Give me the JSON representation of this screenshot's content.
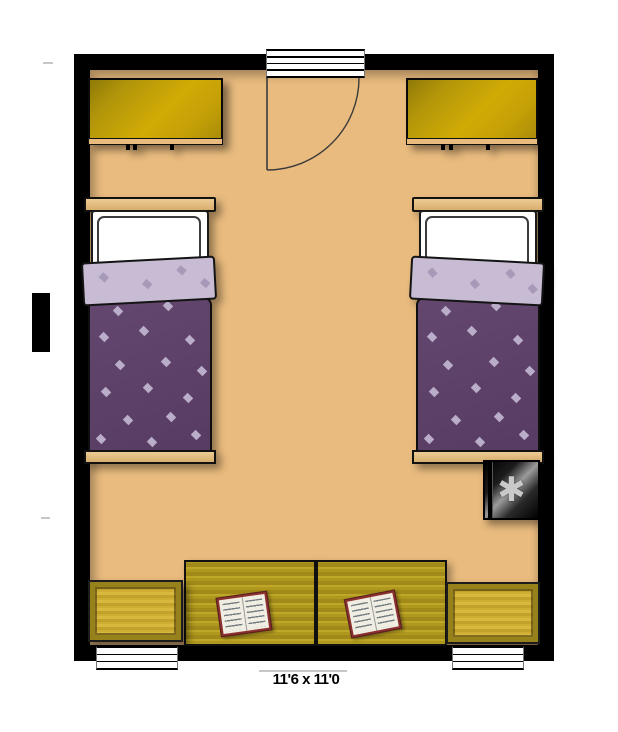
{
  "room": {
    "dimensions_label": "11'6 x 11'0",
    "colors": {
      "wall": "#000000",
      "floor": "#e9bb7e",
      "wardrobe_gold": "#c7a307",
      "duvet_purple": "#5c3f68",
      "sheet_lavender": "#c7bcd4",
      "desk_olive": "#b0981e",
      "book_cover_red": "#8b2f2f"
    }
  },
  "furniture": {
    "fridge": {
      "icon": "✱"
    }
  }
}
